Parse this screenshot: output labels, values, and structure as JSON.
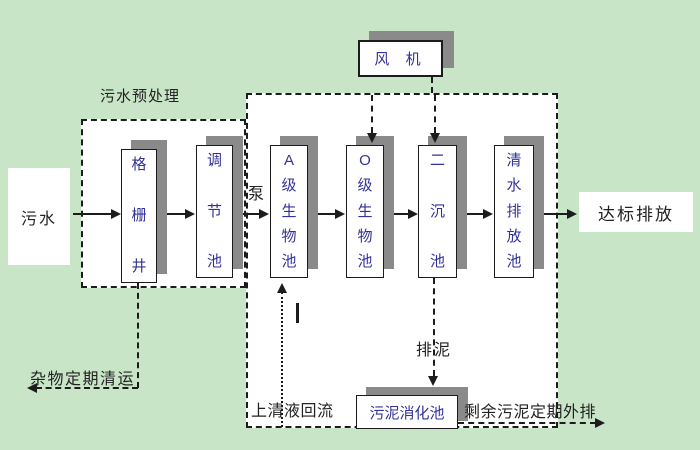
{
  "title": "污水处理工艺流程图",
  "colors": {
    "background": "#c9e5c8",
    "panel": "#ffffff",
    "line": "#1c1c1c",
    "shadow": "#8a8a8a",
    "tank_text": "#32329b",
    "label_text": "#222222"
  },
  "source": {
    "label": "污水"
  },
  "sink": {
    "label": "达标排放"
  },
  "pretreatment": {
    "title": "污水预处理"
  },
  "blower": {
    "label": "风 机"
  },
  "pump": {
    "label": "泵"
  },
  "tanks": [
    {
      "name": "grid-well",
      "label": "格栅井"
    },
    {
      "name": "regulating-tank",
      "label": "调节池"
    },
    {
      "name": "a-bio-tank",
      "label": "A级生物池"
    },
    {
      "name": "o-bio-tank",
      "label": "O级生物池"
    },
    {
      "name": "secondary-clarifier",
      "label": "二沉池"
    },
    {
      "name": "clear-water-tank",
      "label": "清水排放池"
    }
  ],
  "digester": {
    "label": "污泥消化池"
  },
  "flows": {
    "debris_removal": "杂物定期清运",
    "supernatant_return": "上清液回流",
    "sludge_discharge": "排泥",
    "excess_sludge_out": "剩余污泥定期外排"
  }
}
